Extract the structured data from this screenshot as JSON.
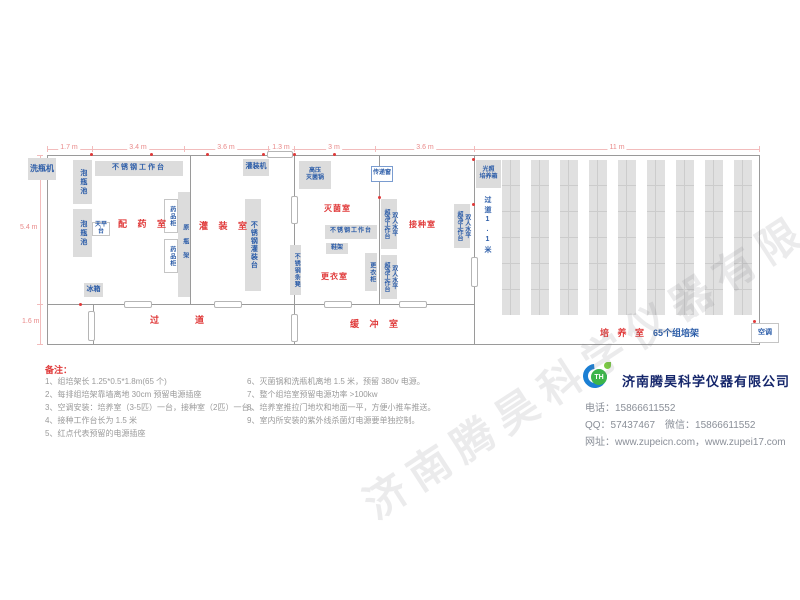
{
  "watermark": "济南腾昊科学仪器有限公司",
  "dims": {
    "top": [
      "1.7 m",
      "3.4 m",
      "3.6 m",
      "1.3 m",
      "3 m",
      "3.6 m",
      "11 m"
    ],
    "left": [
      "5.4 m",
      "1.6 m"
    ]
  },
  "rooms": {
    "prep": "配 药 室",
    "filling": "灌 装 室",
    "corridor": "过　　道",
    "sterilize": "灭菌室",
    "changing": "更衣室",
    "inoculation": "接种室",
    "buffer": "缓 冲 室",
    "culture": "培 养 室",
    "culture_sub": "65个组培架"
  },
  "equipment": {
    "bottle_washer": "洗瓶机",
    "soak_pool": "泡瓶池",
    "ss_worktable": "不锈钢工作台",
    "filling_machine": "灌装机",
    "balance_table": "天平台",
    "fridge": "冰箱",
    "medicine_cabinet": "药品柜",
    "bottle_rack": "原瓶架",
    "ss_filling_table": "不锈钢灌装台",
    "autoclave": "高压\n灭菌锅",
    "pass_window": "传递窗",
    "ss_bench": "不锈钢条凳",
    "shoe_rack": "鞋架",
    "locker": "更衣柜",
    "clean_bench": "双人水平\n超净工作台",
    "light_incubator": "光照\n培养箱",
    "air_conditioner": "空调",
    "aisle_1_1": "过道1.1米",
    "aisle_0_6": "过道0.6米"
  },
  "notes": {
    "title": "备注：",
    "col1": [
      "1、组培架长 1.25*0.5*1.8m(65 个)",
      "2、每排组培架靠墙离地 30cm 预留电源插座",
      "3、空调安装：培养室（3-5匹）一台，接种室（2匹）一台。",
      "4、接种工作台长为 1.5 米",
      "5、红点代表预留的电源插座"
    ],
    "col2": [
      "6、灭菌锅和洗瓶机离地 1.5 米，预留 380v 电源。",
      "7、整个组培室预留电源功率 >100kw",
      "8、培养室推拉门地坎和地面一平，方便小推车推送。",
      "9、室内所安装的紫外线杀菌灯电源要单独控制。"
    ]
  },
  "company": {
    "logo_text": "TH",
    "name": "济南腾昊科学仪器有限公司",
    "lines": [
      "电话：15866611552",
      "QQ：57437467　微信：15866611552",
      "网址：www.zupeicn.com，www.zupei17.com"
    ]
  },
  "colors": {
    "room_label": "#e03a3a",
    "equipment_text": "#2b5ca8",
    "dimension": "#e98a8a",
    "wall": "#9a9a9a",
    "brand_navy": "#15266b",
    "logo_blue": "#1b7fd4",
    "logo_green": "#3cb54a"
  }
}
